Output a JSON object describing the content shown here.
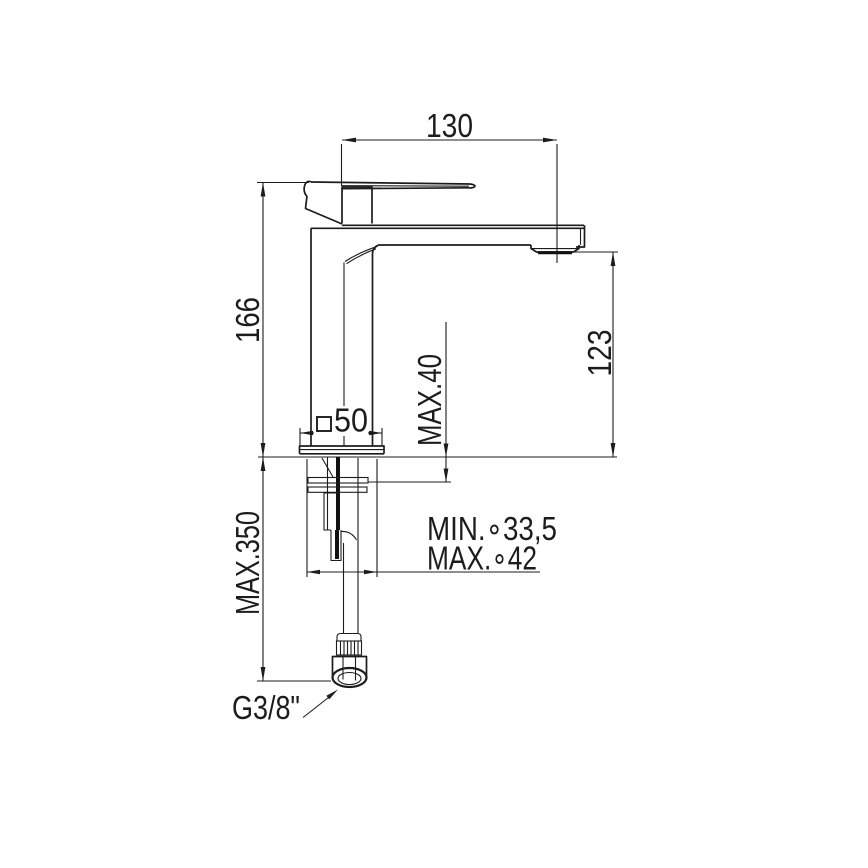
{
  "meta": {
    "drawing_type": "technical dimension drawing",
    "subject": "Single-lever basin mixer tap, side elevation with installation dimensions",
    "units": "mm",
    "line_color": "#1c1c1c",
    "background_color": "#ffffff"
  },
  "labels": {
    "spout_reach": "130",
    "height_to_lever_top": "166",
    "spout_outlet_height": "123",
    "max_deck_thickness": "MAX.40",
    "base_square_value": "50",
    "max_below_deck_length": "MAX.350",
    "min_hole_diameter": "MIN.∘33,5",
    "max_hole_diameter": "MAX.∘42",
    "supply_connection": "G3/8\""
  },
  "values_mm": {
    "spout_reach": 130,
    "height_to_lever_top": 166,
    "spout_outlet_height": 123,
    "max_deck_thickness": 40,
    "base_square_side": 50,
    "max_below_deck_length": 350,
    "min_hole_diameter": 33.5,
    "max_hole_diameter": 42
  },
  "connection_thread": "G3/8\""
}
